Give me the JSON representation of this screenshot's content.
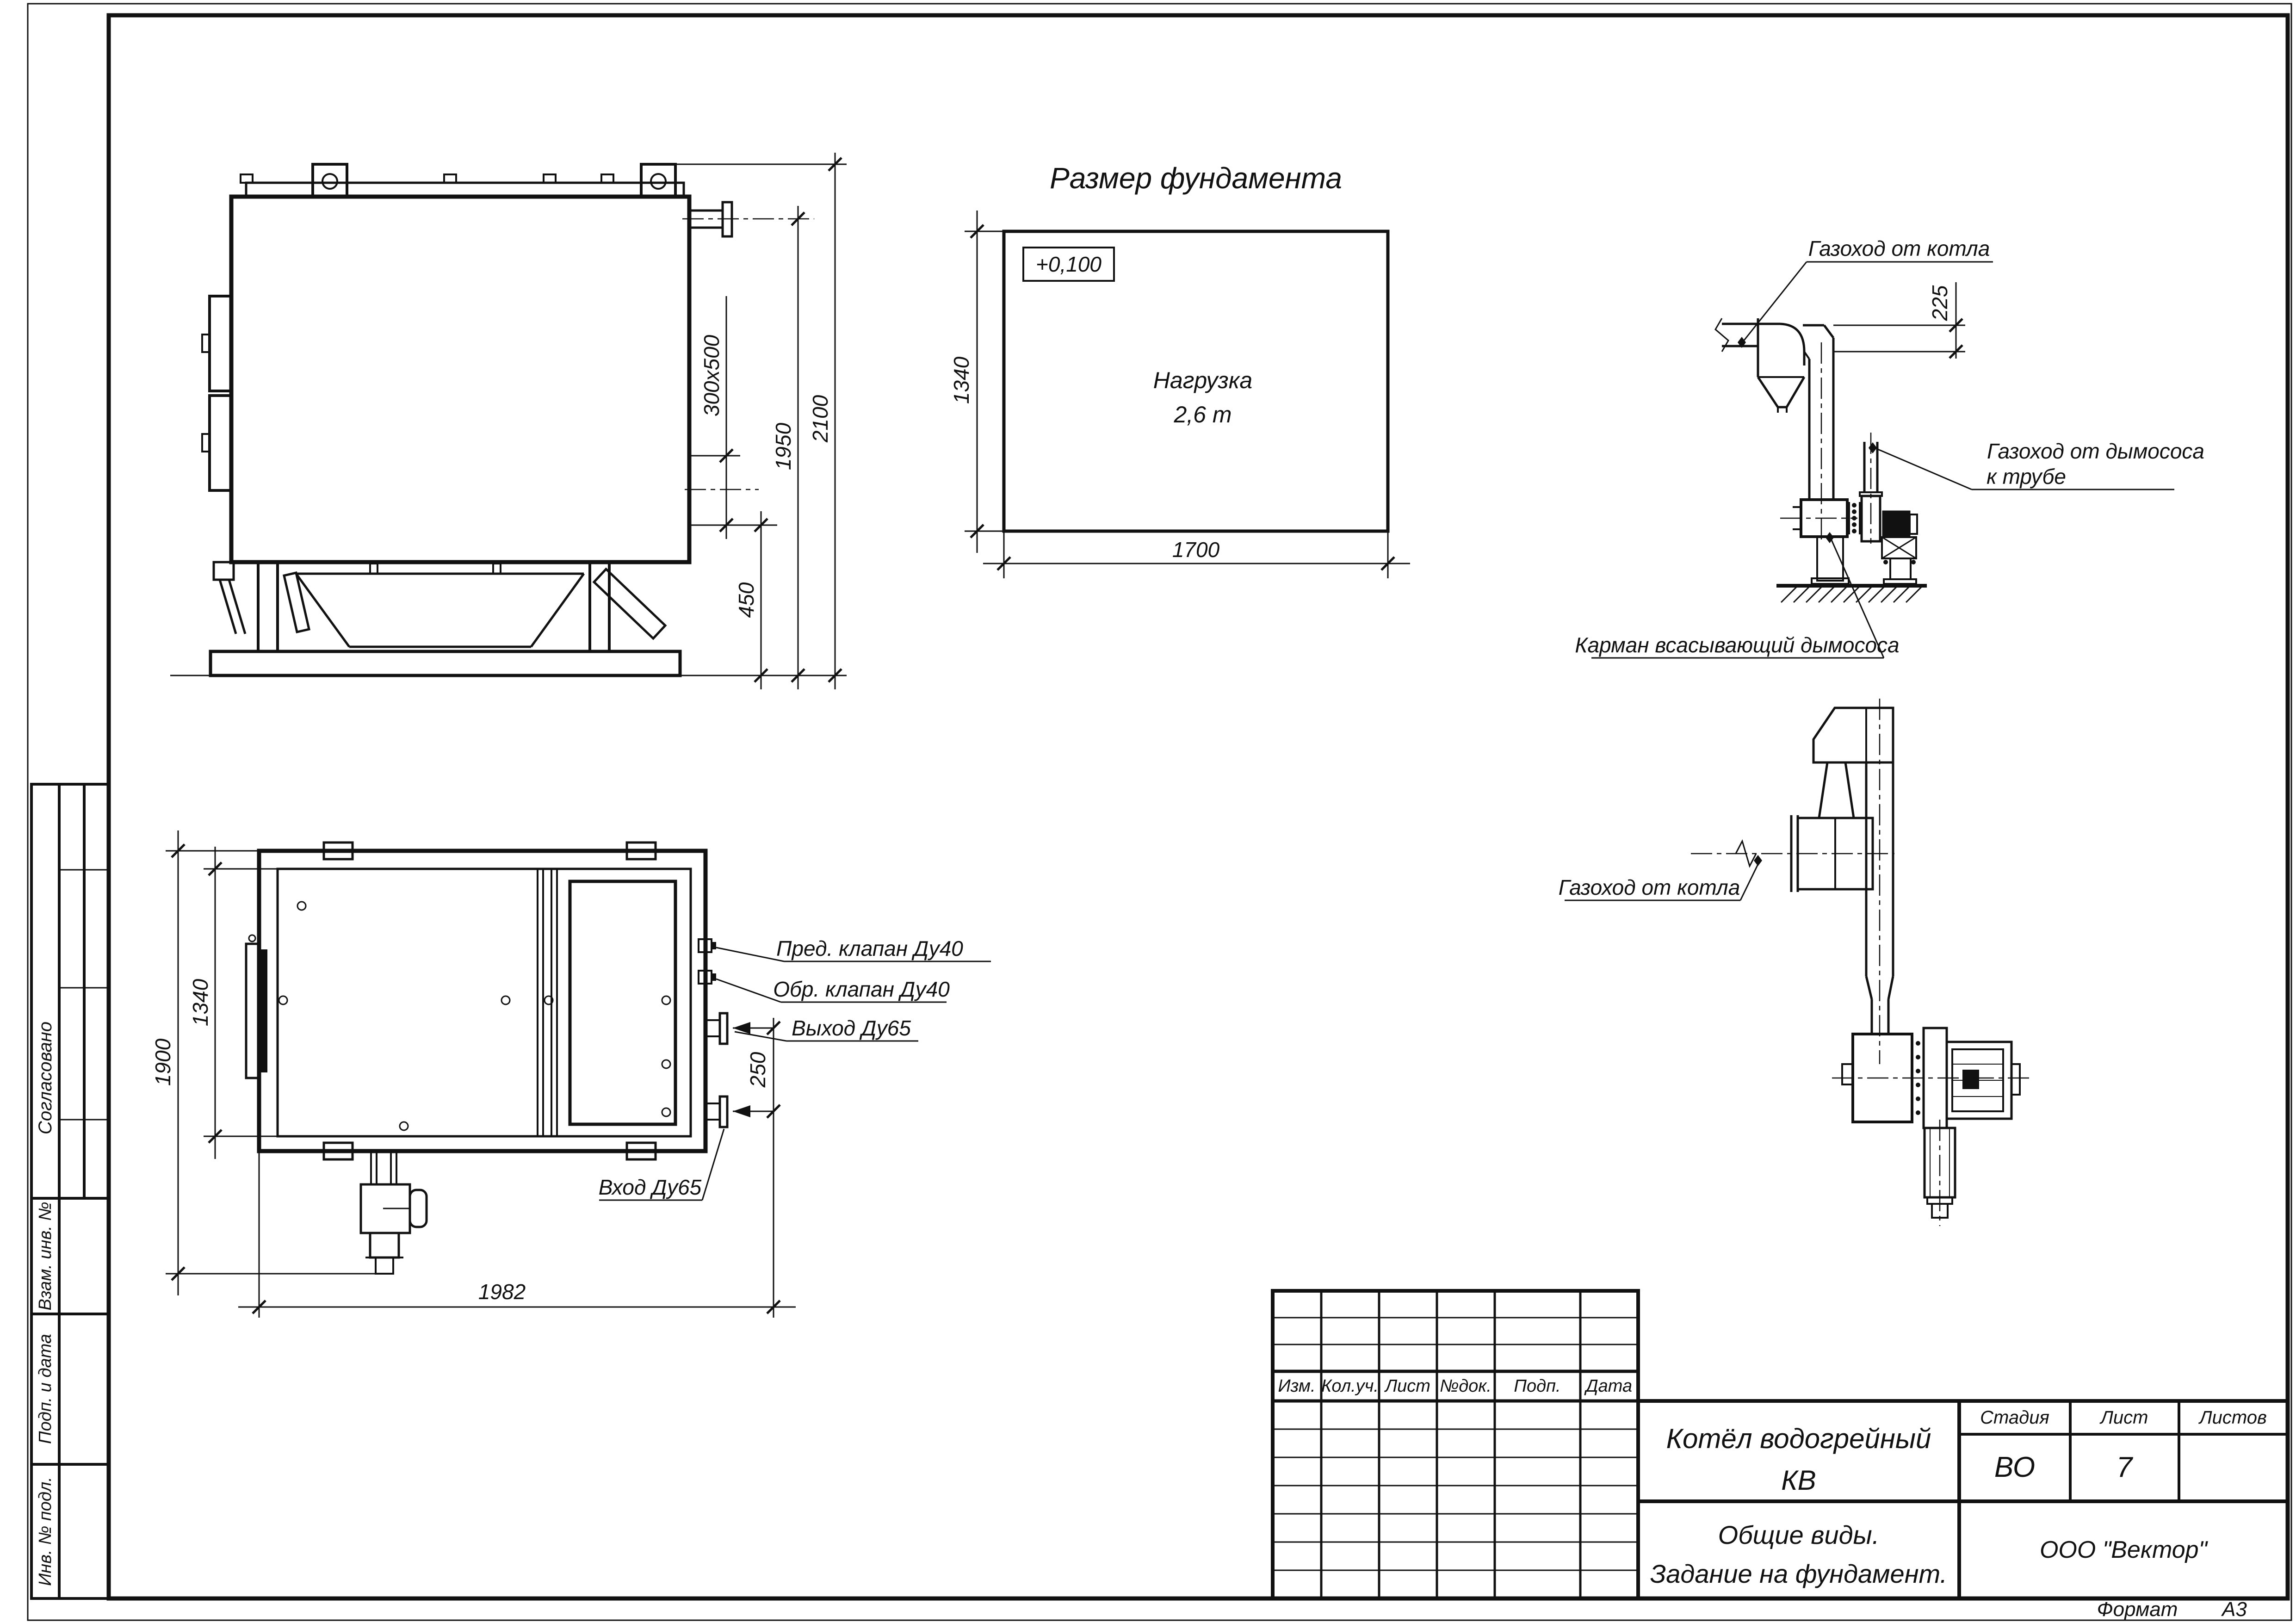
{
  "sheet": {
    "format_label": "Формат",
    "format_value": "А3"
  },
  "side_margin": {
    "soglasovano": "Согласовано",
    "vzam_inv": "Взам. инв. №",
    "podp_data": "Подп. и дата",
    "inv_podl": "Инв. № подл."
  },
  "title_block": {
    "rev_headers": [
      "Изм.",
      "Кол.уч.",
      "Лист",
      "№док.",
      "Подп.",
      "Дата"
    ],
    "doc_title_line1": "Котёл водогрейный",
    "doc_title_line2": "КВ",
    "doc_subtitle_line1": "Общие виды.",
    "doc_subtitle_line2": "Задание на фундамент.",
    "stage_label": "Стадия",
    "stage_value": "ВО",
    "sheet_label": "Лист",
    "sheet_value": "7",
    "sheets_label": "Листов",
    "company": "ООО \"Вектор\""
  },
  "foundation_plan": {
    "title": "Размер фундамента",
    "elevation_mark": "+0,100",
    "load_line1": "Нагрузка",
    "load_line2": "2,6 т",
    "dim_width": "1700",
    "dim_height": "1340"
  },
  "side_view": {
    "dim_duct": "300х500",
    "dim_1950": "1950",
    "dim_2100": "2100",
    "dim_450": "450"
  },
  "plan_view": {
    "dim_1900": "1900",
    "dim_1340": "1340",
    "dim_1982": "1982",
    "dim_250": "250",
    "label_safety_valve": "Пред. клапан Ду40",
    "label_check_valve": "Обр. клапан Ду40",
    "label_outlet": "Выход Ду65",
    "label_inlet": "Вход Ду65"
  },
  "flue_elevation": {
    "label_from_boiler": "Газоход от котла",
    "label_to_stack_line1": "Газоход от дымососа",
    "label_to_stack_line2": "к трубе",
    "label_pocket": "Карман всасывающий дымососа",
    "dim_225": "225"
  },
  "flue_plan": {
    "label_from_boiler": "Газоход от котла"
  }
}
